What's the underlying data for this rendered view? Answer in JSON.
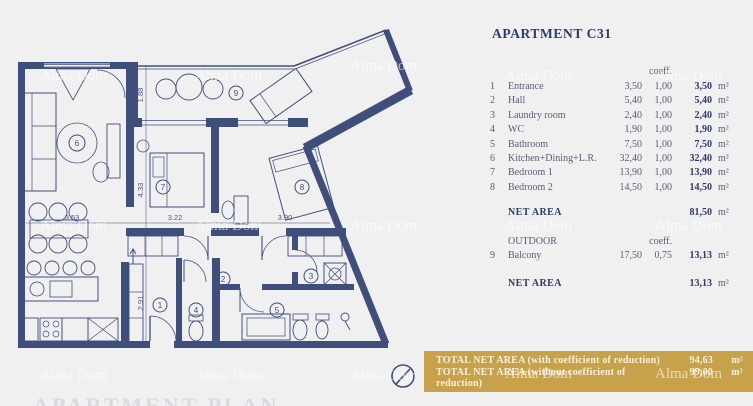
{
  "watermark": "Alma Dom",
  "plan": {
    "caption": "APARTMENT PLAN",
    "rooms": [
      "1",
      "2",
      "3",
      "4",
      "5",
      "6",
      "7",
      "8",
      "9"
    ],
    "dims": {
      "v1": "1.88",
      "v2": "4.33",
      "v3": "2.91",
      "h1": "3.53",
      "h2": "3.22",
      "h3": "3.90"
    }
  },
  "panel": {
    "title": "APARTMENT C31",
    "coeff_header": "coeff.",
    "rows": [
      {
        "num": "1",
        "name": "Entrance",
        "area": "3,50",
        "coeff": "1,00",
        "result": "3,50",
        "unit": "m²"
      },
      {
        "num": "2",
        "name": "Hall",
        "area": "5,40",
        "coeff": "1,00",
        "result": "5,40",
        "unit": "m²"
      },
      {
        "num": "3",
        "name": "Laundry room",
        "area": "2,40",
        "coeff": "1,00",
        "result": "2,40",
        "unit": "m²"
      },
      {
        "num": "4",
        "name": "WC",
        "area": "1,90",
        "coeff": "1,00",
        "result": "1,90",
        "unit": "m²"
      },
      {
        "num": "5",
        "name": "Bathroom",
        "area": "7,50",
        "coeff": "1,00",
        "result": "7,50",
        "unit": "m²"
      },
      {
        "num": "6",
        "name": "Kitchen+Dining+L.R.",
        "area": "32,40",
        "coeff": "1,00",
        "result": "32,40",
        "unit": "m²"
      },
      {
        "num": "7",
        "name": "Bedroom 1",
        "area": "13,90",
        "coeff": "1,00",
        "result": "13,90",
        "unit": "m²"
      },
      {
        "num": "8",
        "name": "Bedroom 2",
        "area": "14,50",
        "coeff": "1,00",
        "result": "14,50",
        "unit": "m²"
      }
    ],
    "net_area": {
      "label": "NET AREA",
      "value": "81,50",
      "unit": "m²"
    },
    "outdoor_label": "OUTDOOR",
    "outdoor_coeff_header": "coeff.",
    "outdoor_row": {
      "num": "9",
      "name": "Balcony",
      "area": "17,50",
      "coeff": "0,75",
      "result": "13,13",
      "unit": "m²"
    },
    "outdoor_net": {
      "label": "NET AREA",
      "value": "13,13",
      "unit": "m²"
    }
  },
  "totals": {
    "bar_color": "#c8a24b",
    "rows": [
      {
        "label": "TOTAL NET AREA (with coefficient of reduction)",
        "value": "94,63",
        "unit": "m²"
      },
      {
        "label": "TOTAL NET AREA (without coefficient of reduction)",
        "value": "99,00",
        "unit": "m²"
      }
    ]
  }
}
